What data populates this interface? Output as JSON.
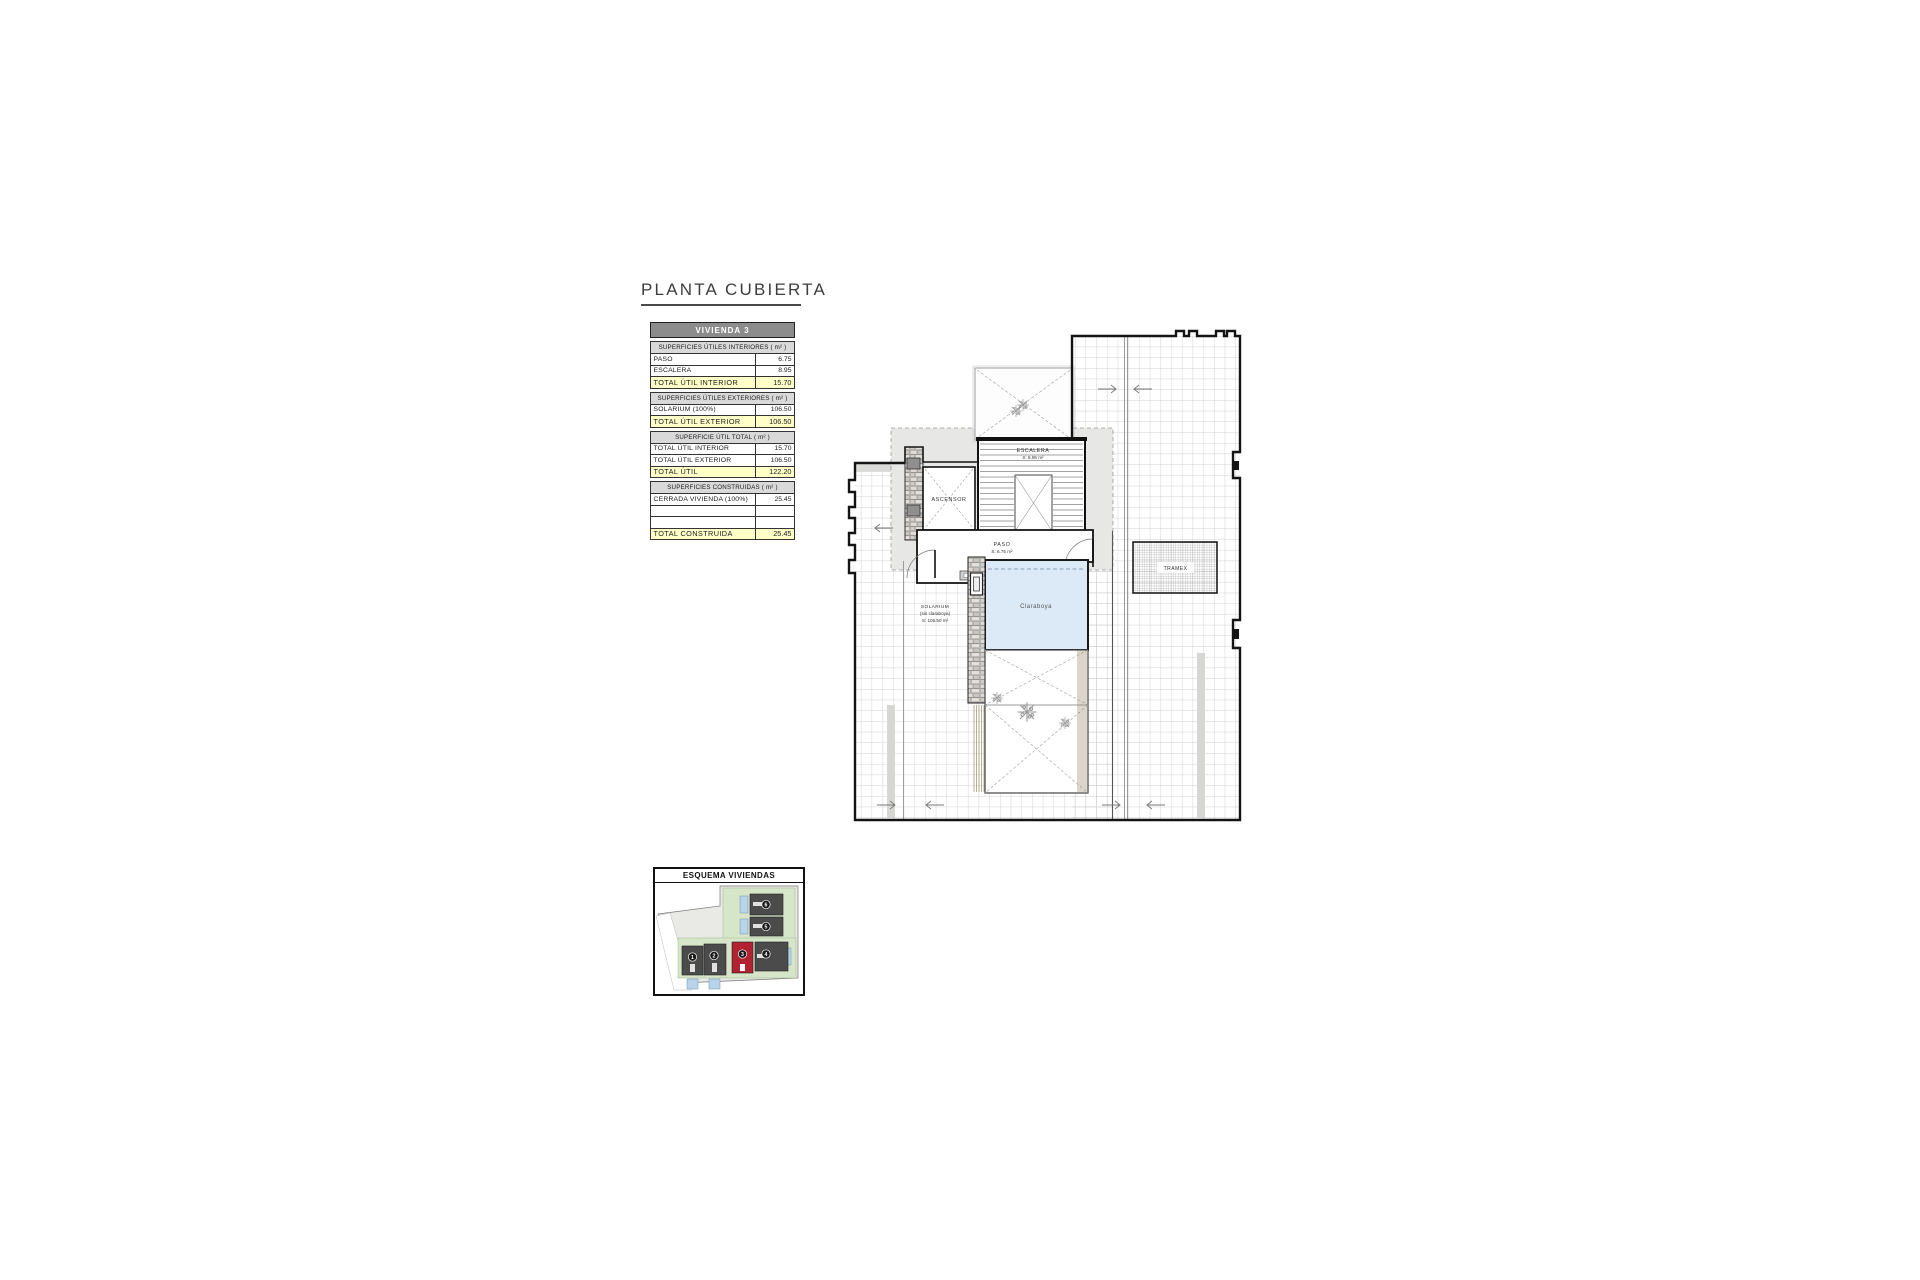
{
  "page": {
    "title": "PLANTA CUBIERTA"
  },
  "table": {
    "header": "VIVIENDA 3",
    "sections": [
      {
        "title": "SUPERFICIES ÚTILES INTERIORES ( m² )",
        "rows": [
          {
            "label": "PASO",
            "value": "6.75"
          },
          {
            "label": "ESCALERA",
            "value": "8.95"
          },
          {
            "label": "TOTAL ÚTIL INTERIOR",
            "value": "15.70"
          }
        ]
      },
      {
        "title": "SUPERFICIES ÚTILES EXTERIORES ( m² )",
        "rows": [
          {
            "label": "SOLARIUM (100%)",
            "value": "106.50"
          },
          {
            "label": "TOTAL ÚTIL EXTERIOR",
            "value": "106.50"
          }
        ]
      },
      {
        "title": "SUPERFICIE ÚTIL TOTAL ( m² )",
        "rows": [
          {
            "label": "TOTAL ÚTIL INTERIOR",
            "value": "15.70"
          },
          {
            "label": "TOTAL ÚTIL EXTERIOR",
            "value": "106.50"
          },
          {
            "label": "TOTAL ÚTIL",
            "value": "122.20"
          }
        ]
      },
      {
        "title": "SUPERFICIES CONSTRUIDAS ( m² )",
        "rows": [
          {
            "label": "CERRADA VIVIENDA (100%)",
            "value": "25.45"
          },
          {
            "label": "",
            "value": ""
          },
          {
            "label": "",
            "value": ""
          },
          {
            "label": "TOTAL CONSTRUIDA",
            "value": "25.45"
          }
        ]
      }
    ]
  },
  "plan": {
    "rooms": {
      "escalera": {
        "name": "ESCALERA",
        "area": "S: 8.95 m²"
      },
      "ascensor": {
        "name": "ASCENSOR"
      },
      "paso": {
        "name": "PASO",
        "area": "S: 6.75 m²"
      },
      "solarium": {
        "name": "SOLARIUM",
        "note": "(sin claraboya)",
        "area": "S: 106.50 m²"
      },
      "claraboya": {
        "name": "Claraboya"
      },
      "tramex": {
        "name": "TRAMEX"
      }
    }
  },
  "esquema": {
    "title": "ESQUEMA VIVIENDAS",
    "highlighted_unit": "3",
    "units": [
      "1",
      "2",
      "3",
      "4",
      "5",
      "6"
    ]
  },
  "colors": {
    "highlight_yellow": "#FFFFC8",
    "table_header_gray": "#8C8C8C",
    "section_gray": "#D9D9D9",
    "claraboya_blue": "#DCEAF8",
    "red_unit": "#B12233",
    "garden_green": "#D7E6C9",
    "pool_blue": "#B9D3EA"
  }
}
